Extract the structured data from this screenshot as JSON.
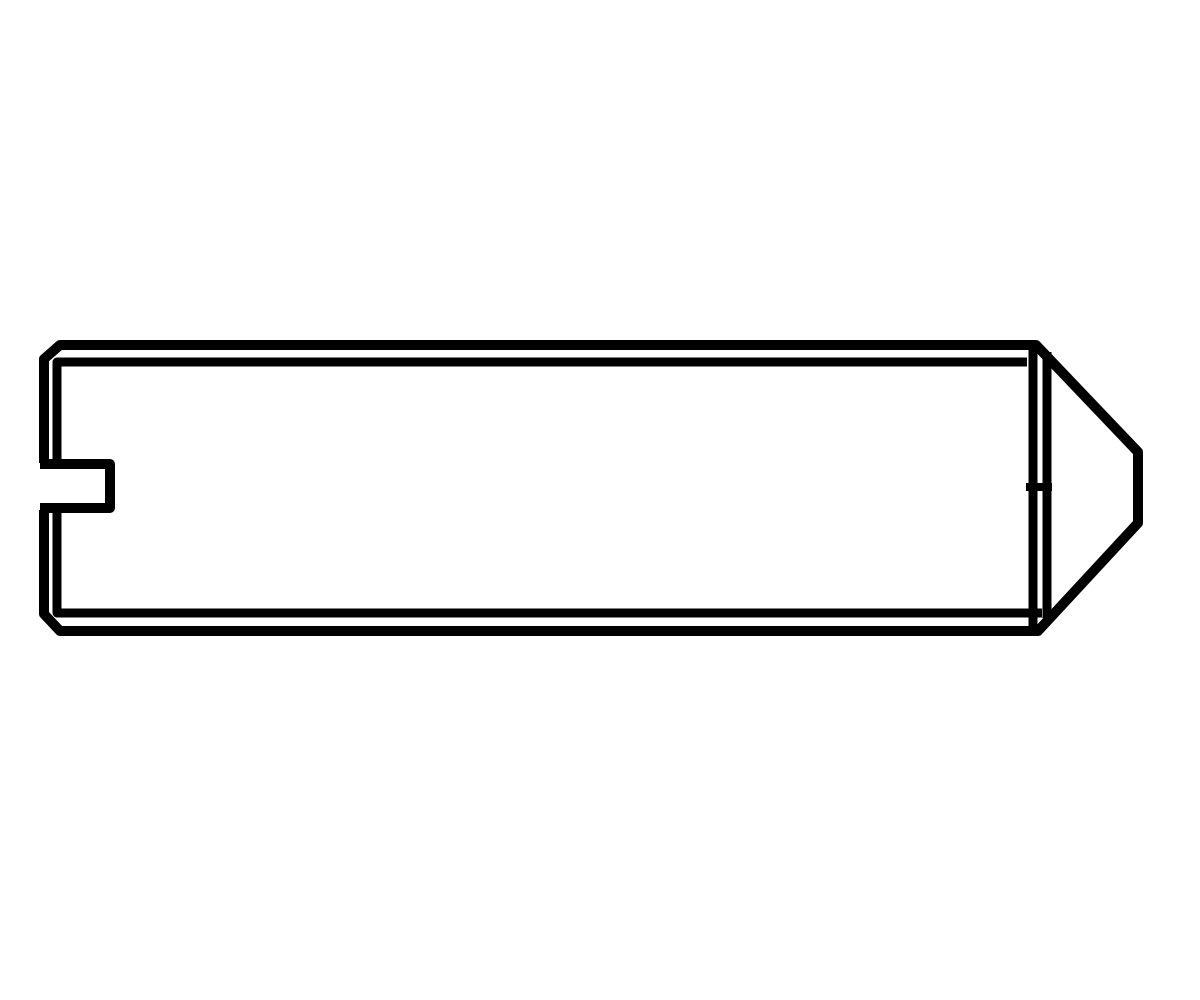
{
  "canvas": {
    "width": 1200,
    "height": 1000,
    "background_color": "#ffffff",
    "stroke_color": "#000000"
  },
  "drawing": {
    "paths": [
      {
        "name": "screw-body-outline",
        "d": "M 44 463 L 44 359 L 60 345 L 1036 345 L 1138 452 L 1138 523 L 1038 631 L 60 631 L 44 614 L 44 510",
        "width": 10
      },
      {
        "name": "top-chamfer-inner-line",
        "d": "M 1027 362 L 57 362 L 57 463",
        "width": 9
      },
      {
        "name": "bottom-chamfer-inner-line",
        "d": "M 57 510 L 57 613 L 1042 613",
        "width": 9
      },
      {
        "name": "drive-slot-notch",
        "d": "M 40 464 L 110 464 L 110 508 L 40 508",
        "width": 10
      },
      {
        "name": "thread-end-line",
        "d": "M 1033 347 L 1033 629",
        "width": 9
      },
      {
        "name": "cone-base-line",
        "d": "M 1047 352 L 1047 618",
        "width": 9
      },
      {
        "name": "center-axis-tick",
        "d": "M 1026 487 L 1052 487",
        "width": 8
      }
    ]
  }
}
